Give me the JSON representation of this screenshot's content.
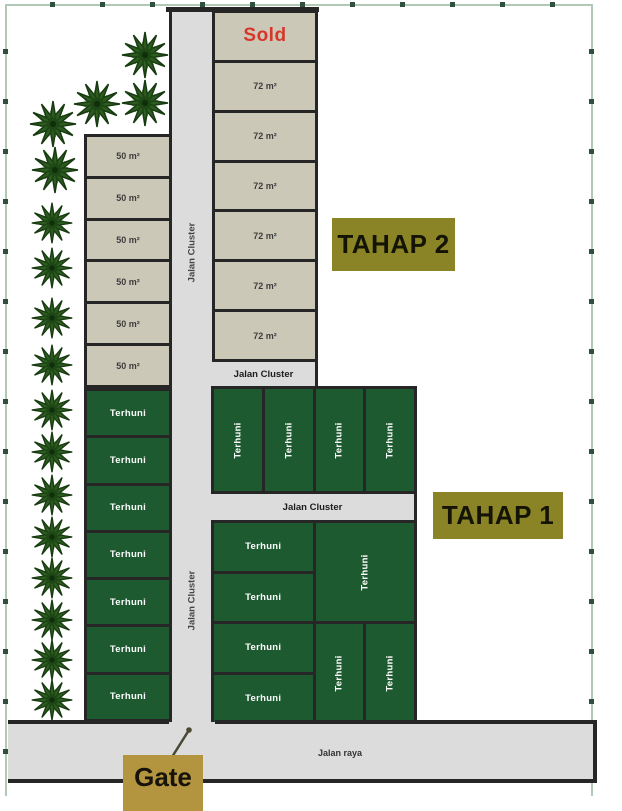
{
  "phase_labels": {
    "tahap2": "TAHAP 2",
    "tahap1": "TAHAP 1"
  },
  "gate": {
    "label": "Gate"
  },
  "roads": {
    "cluster": "Jalan Cluster",
    "main": "Jalan raya"
  },
  "lots": {
    "center": [
      "Sold",
      "72 m²",
      "72 m²",
      "72 m²",
      "72 m²",
      "72 m²",
      "72 m²"
    ],
    "left_beige": [
      "50 m²",
      "50 m²",
      "50 m²",
      "50 m²",
      "50 m²",
      "50 m²"
    ],
    "left_green": [
      "Terhuni",
      "Terhuni",
      "Terhuni",
      "Terhuni",
      "Terhuni",
      "Terhuni",
      "Terhuni"
    ],
    "mid_row": [
      "Terhuni",
      "Terhuni",
      "Terhuni",
      "Terhuni"
    ],
    "lower_left": [
      "Terhuni",
      "Terhuni",
      "Terhuni",
      "Terhuni"
    ],
    "lower_right_big": "Terhuni",
    "lower_right_pair": [
      "Terhuni",
      "Terhuni"
    ]
  },
  "colors": {
    "lot_beige": "#cbc8b8",
    "lot_green": "#1d5a2f",
    "road_gray": "#dcdcdc",
    "wall": "#262626",
    "phase_box": "#8a8426",
    "gate_box": "#b2953e",
    "sold_text": "#d7372b",
    "frame": "#b3c7b7",
    "tree_green": "#2e5c20"
  },
  "trees": {
    "positions": [
      [
        145,
        55,
        50
      ],
      [
        97,
        104,
        50
      ],
      [
        145,
        103,
        50
      ],
      [
        53,
        124,
        50
      ],
      [
        55,
        170,
        50
      ],
      [
        52,
        223,
        44
      ],
      [
        52,
        268,
        44
      ],
      [
        52,
        318,
        44
      ],
      [
        52,
        365,
        44
      ],
      [
        52,
        410,
        44
      ],
      [
        52,
        452,
        44
      ],
      [
        52,
        495,
        44
      ],
      [
        52,
        537,
        44
      ],
      [
        52,
        578,
        44
      ],
      [
        52,
        620,
        44
      ],
      [
        52,
        660,
        44
      ],
      [
        52,
        700,
        44
      ]
    ]
  }
}
